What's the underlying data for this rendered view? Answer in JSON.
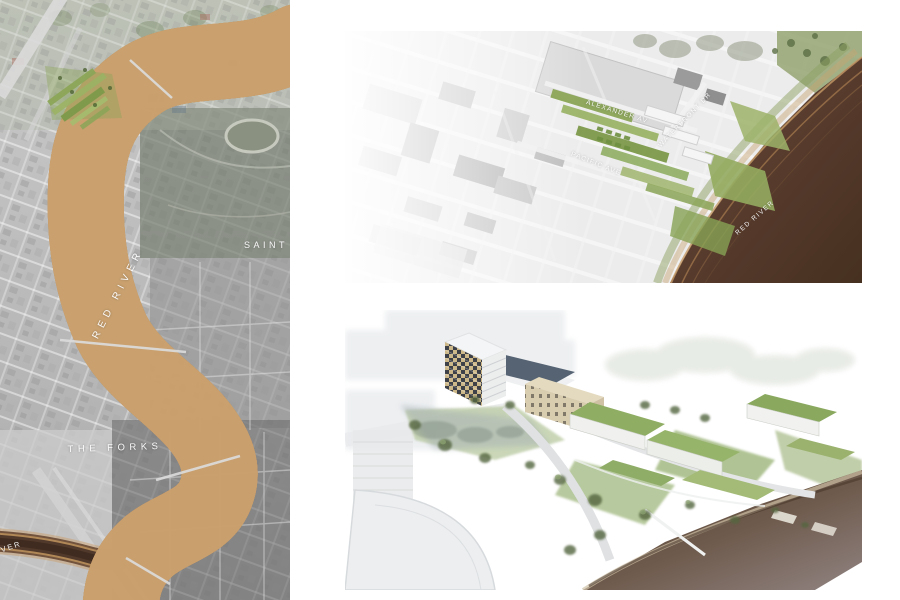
{
  "board": {
    "description": "architectural riverfront masterplan presentation board"
  },
  "panels": {
    "context_map": {
      "kind": "aerial context map",
      "labels": {
        "red_river": "RED RIVER",
        "saint_boniface": "SAINT B",
        "the_forks": "THE FORKS",
        "assiniboine_river": "RIVER"
      }
    },
    "site_plan": {
      "kind": "aerial site plan with design overlay",
      "labels": {
        "alexander_av": "ALEXANDER AV",
        "waterfront_dr": "WATERFRONT DR",
        "pacific_ave": "PACIFIC AVE",
        "red_river": "RED RIVER"
      }
    },
    "rendering": {
      "kind": "3d aerial rendering of waterfront development"
    }
  },
  "colors": {
    "background": "#ffffff",
    "river_dark_brown": "#412b1f",
    "river_contour_tan": "#caa06e",
    "design_green": "#84a251",
    "aerial_gray": "#bdbdbd",
    "render_slate_roof": "#4d5b6c",
    "render_beige": "#d9cdb0",
    "render_green_roof": "#8fae63",
    "render_water_mauve": "#8d7f7c"
  }
}
